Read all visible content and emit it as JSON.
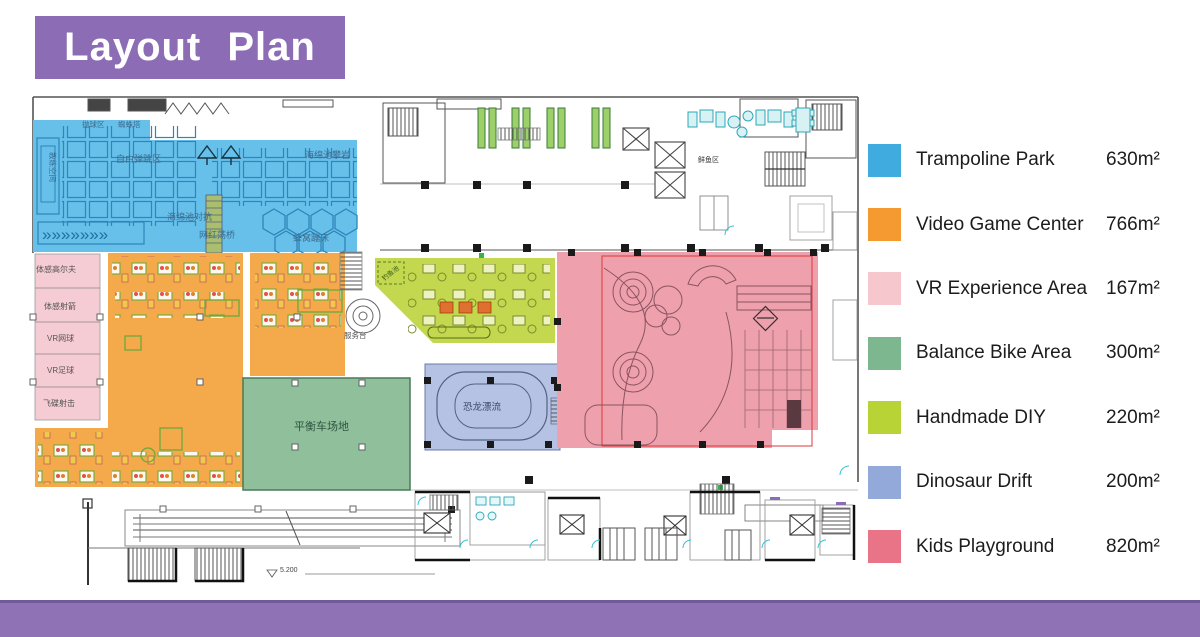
{
  "title": "Layout Plan",
  "colors": {
    "header_purple": "#8d6cb6",
    "footer_purple": "#8e72b5",
    "footer_edge": "#6f5b99"
  },
  "legend": {
    "items": [
      {
        "label": "Trampoline Park",
        "area": "630m²",
        "color": "#3fabdf"
      },
      {
        "label": "Video Game Center",
        "area": "766m²",
        "color": "#f49a31"
      },
      {
        "label": "VR Experience Area",
        "area": "167m²",
        "color": "#f6c7cd"
      },
      {
        "label": "Balance Bike Area",
        "area": "300m²",
        "color": "#7db790"
      },
      {
        "label": "Handmade DIY",
        "area": "220m²",
        "color": "#b8d335"
      },
      {
        "label": "Dinosaur Drift",
        "area": "200m²",
        "color": "#93a9d9"
      },
      {
        "label": "Kids Playground",
        "area": "820m²",
        "color": "#e97487"
      }
    ]
  },
  "plan": {
    "labels": {
      "ball_zone": "抛球区",
      "spider_tower": "蜘蛛塔",
      "free_jump": "自由弹跳区",
      "sponge_climb": "海绵池攀岩",
      "sponge_battle": "海绵池对抗",
      "swing_bridge": "网红荡桥",
      "honeycomb": "蜂窝蹦床",
      "coach_space": "教练空间",
      "golf": "体感高尔夫",
      "archery": "体感射箭",
      "vr_tennis": "VR网球",
      "vr_soccer": "VR足球",
      "saucer": "飞碟射击",
      "balance_field": "平衡车场地",
      "dino_drift": "恐龙漂流",
      "fish_pond": "钓鱼池",
      "service_desk": "服务台",
      "fresh_area": "鲜鱼区"
    },
    "level_mark": "5.200"
  }
}
